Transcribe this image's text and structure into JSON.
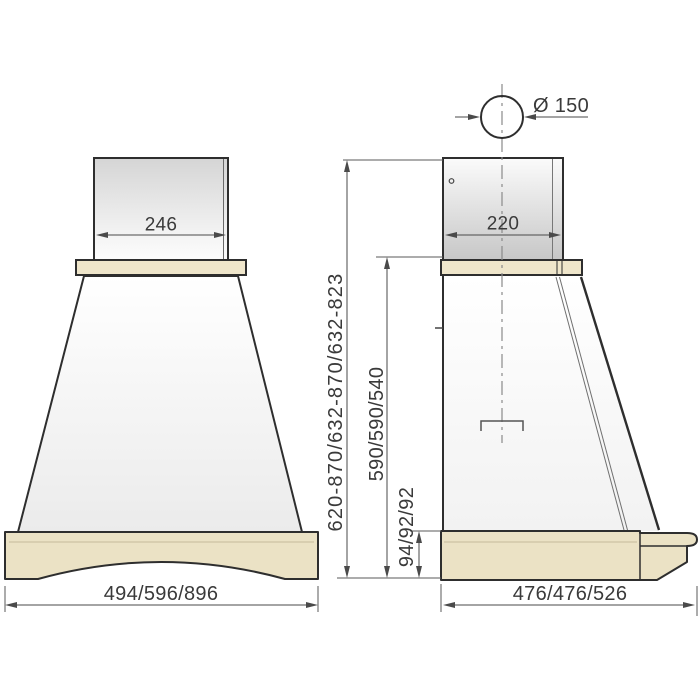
{
  "labels": {
    "front_chimney_width": "246",
    "side_chimney_depth": "220",
    "duct_diameter": "Ø 150",
    "total_height": "620-870/632-870/632-823",
    "hood_body_height": "590/590/540",
    "base_height": "94/92/92",
    "front_overall_width": "494/596/896",
    "side_overall_depth": "476/476/526"
  },
  "colors": {
    "outline": "#2e2e2e",
    "wood_fill": "#ebe2c5",
    "shelf_fill": "#efe6cb",
    "dimension_line": "#4a4a4a",
    "text": "#3a3a3a"
  }
}
